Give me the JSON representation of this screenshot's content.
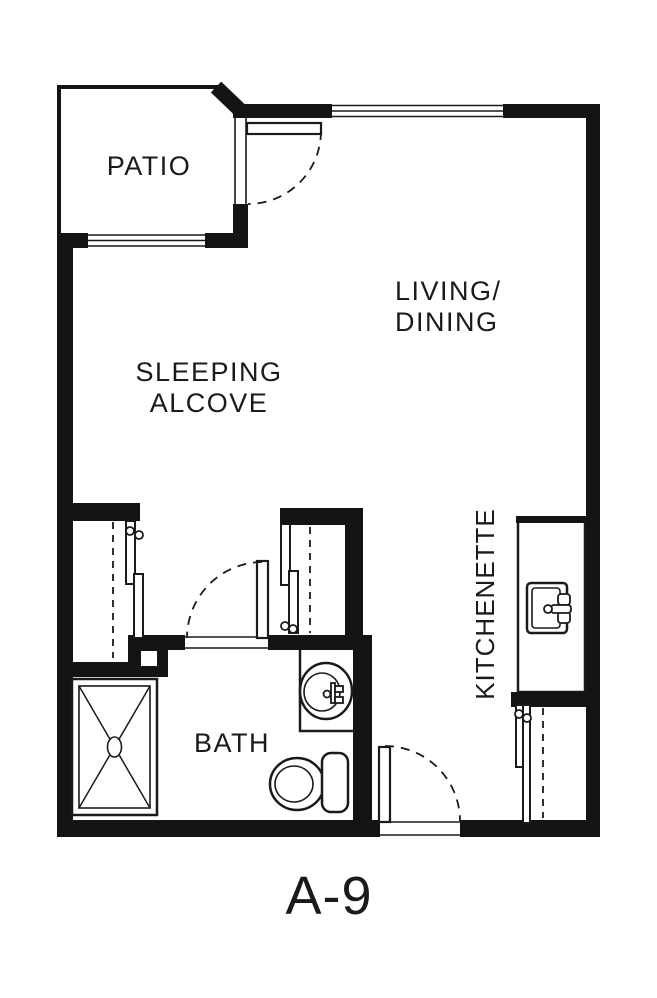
{
  "plan": {
    "title": "A-9",
    "labels": {
      "patio": "PATIO",
      "living_dining": [
        "LIVING/",
        "DINING"
      ],
      "sleeping_alcove": [
        "SLEEPING",
        "ALCOVE"
      ],
      "bath": "BATH",
      "kitchenette": "KITCHENETTE"
    },
    "colors": {
      "wall": "#141414",
      "line": "#1a1a1a",
      "background": "#ffffff"
    }
  }
}
